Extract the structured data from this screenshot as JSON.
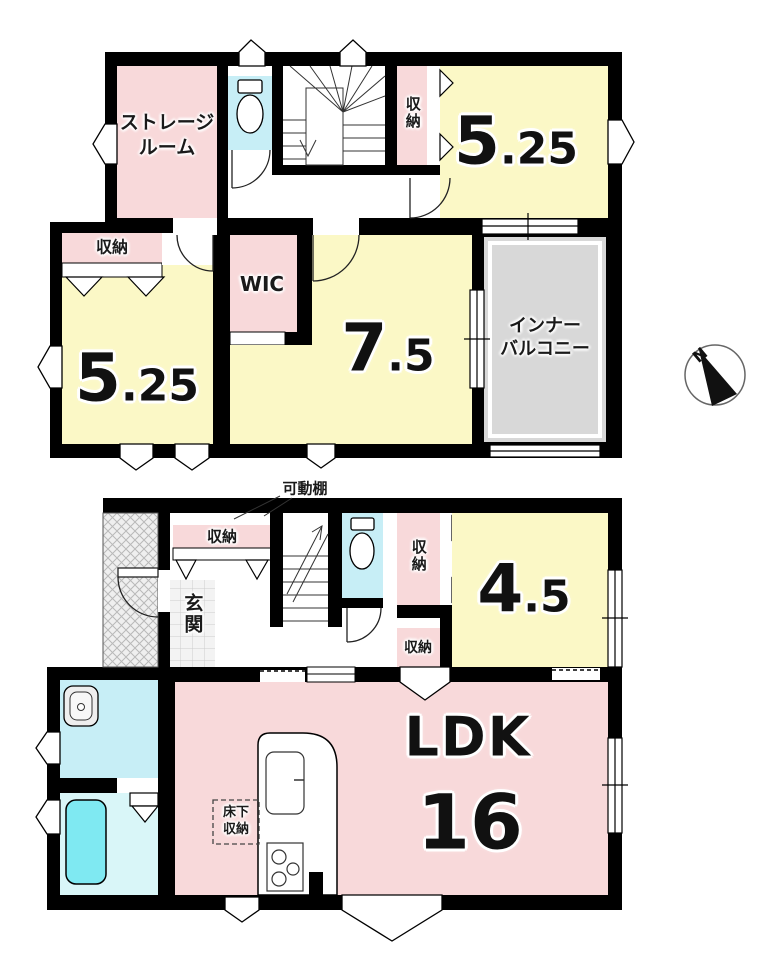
{
  "f2": {
    "storage_label": "ストレージ\nルーム",
    "closet_top_label": "収納",
    "room525a_int": "5",
    "room525a_dec": ".25",
    "closet_left_label": "収納",
    "room525b_int": "5",
    "room525b_dec": ".25",
    "wic_label": "WIC",
    "room75_int": "7",
    "room75_dec": ".5",
    "balcony_label": "インナー\nバルコニー",
    "compass_label": "N"
  },
  "f1": {
    "shelf_note_label": "可動棚",
    "entry_closet_label": "収納",
    "genkan_label": "玄関",
    "mid_closet_label": "収納",
    "room45_int": "4",
    "room45_dec": ".5",
    "low_closet_label": "収納",
    "ldk_label": "LDK",
    "ldk_size": "16",
    "floor_storage_label": "床下\n収納"
  },
  "colors": {
    "room_pink": "#f8d9da",
    "room_yellow": "#fbf8c6",
    "wet_cyan": "#c7eef6",
    "tub_cyan": "#7fe9f2",
    "balcony_gray": "#d8d8d8",
    "wall_black": "#000000"
  }
}
